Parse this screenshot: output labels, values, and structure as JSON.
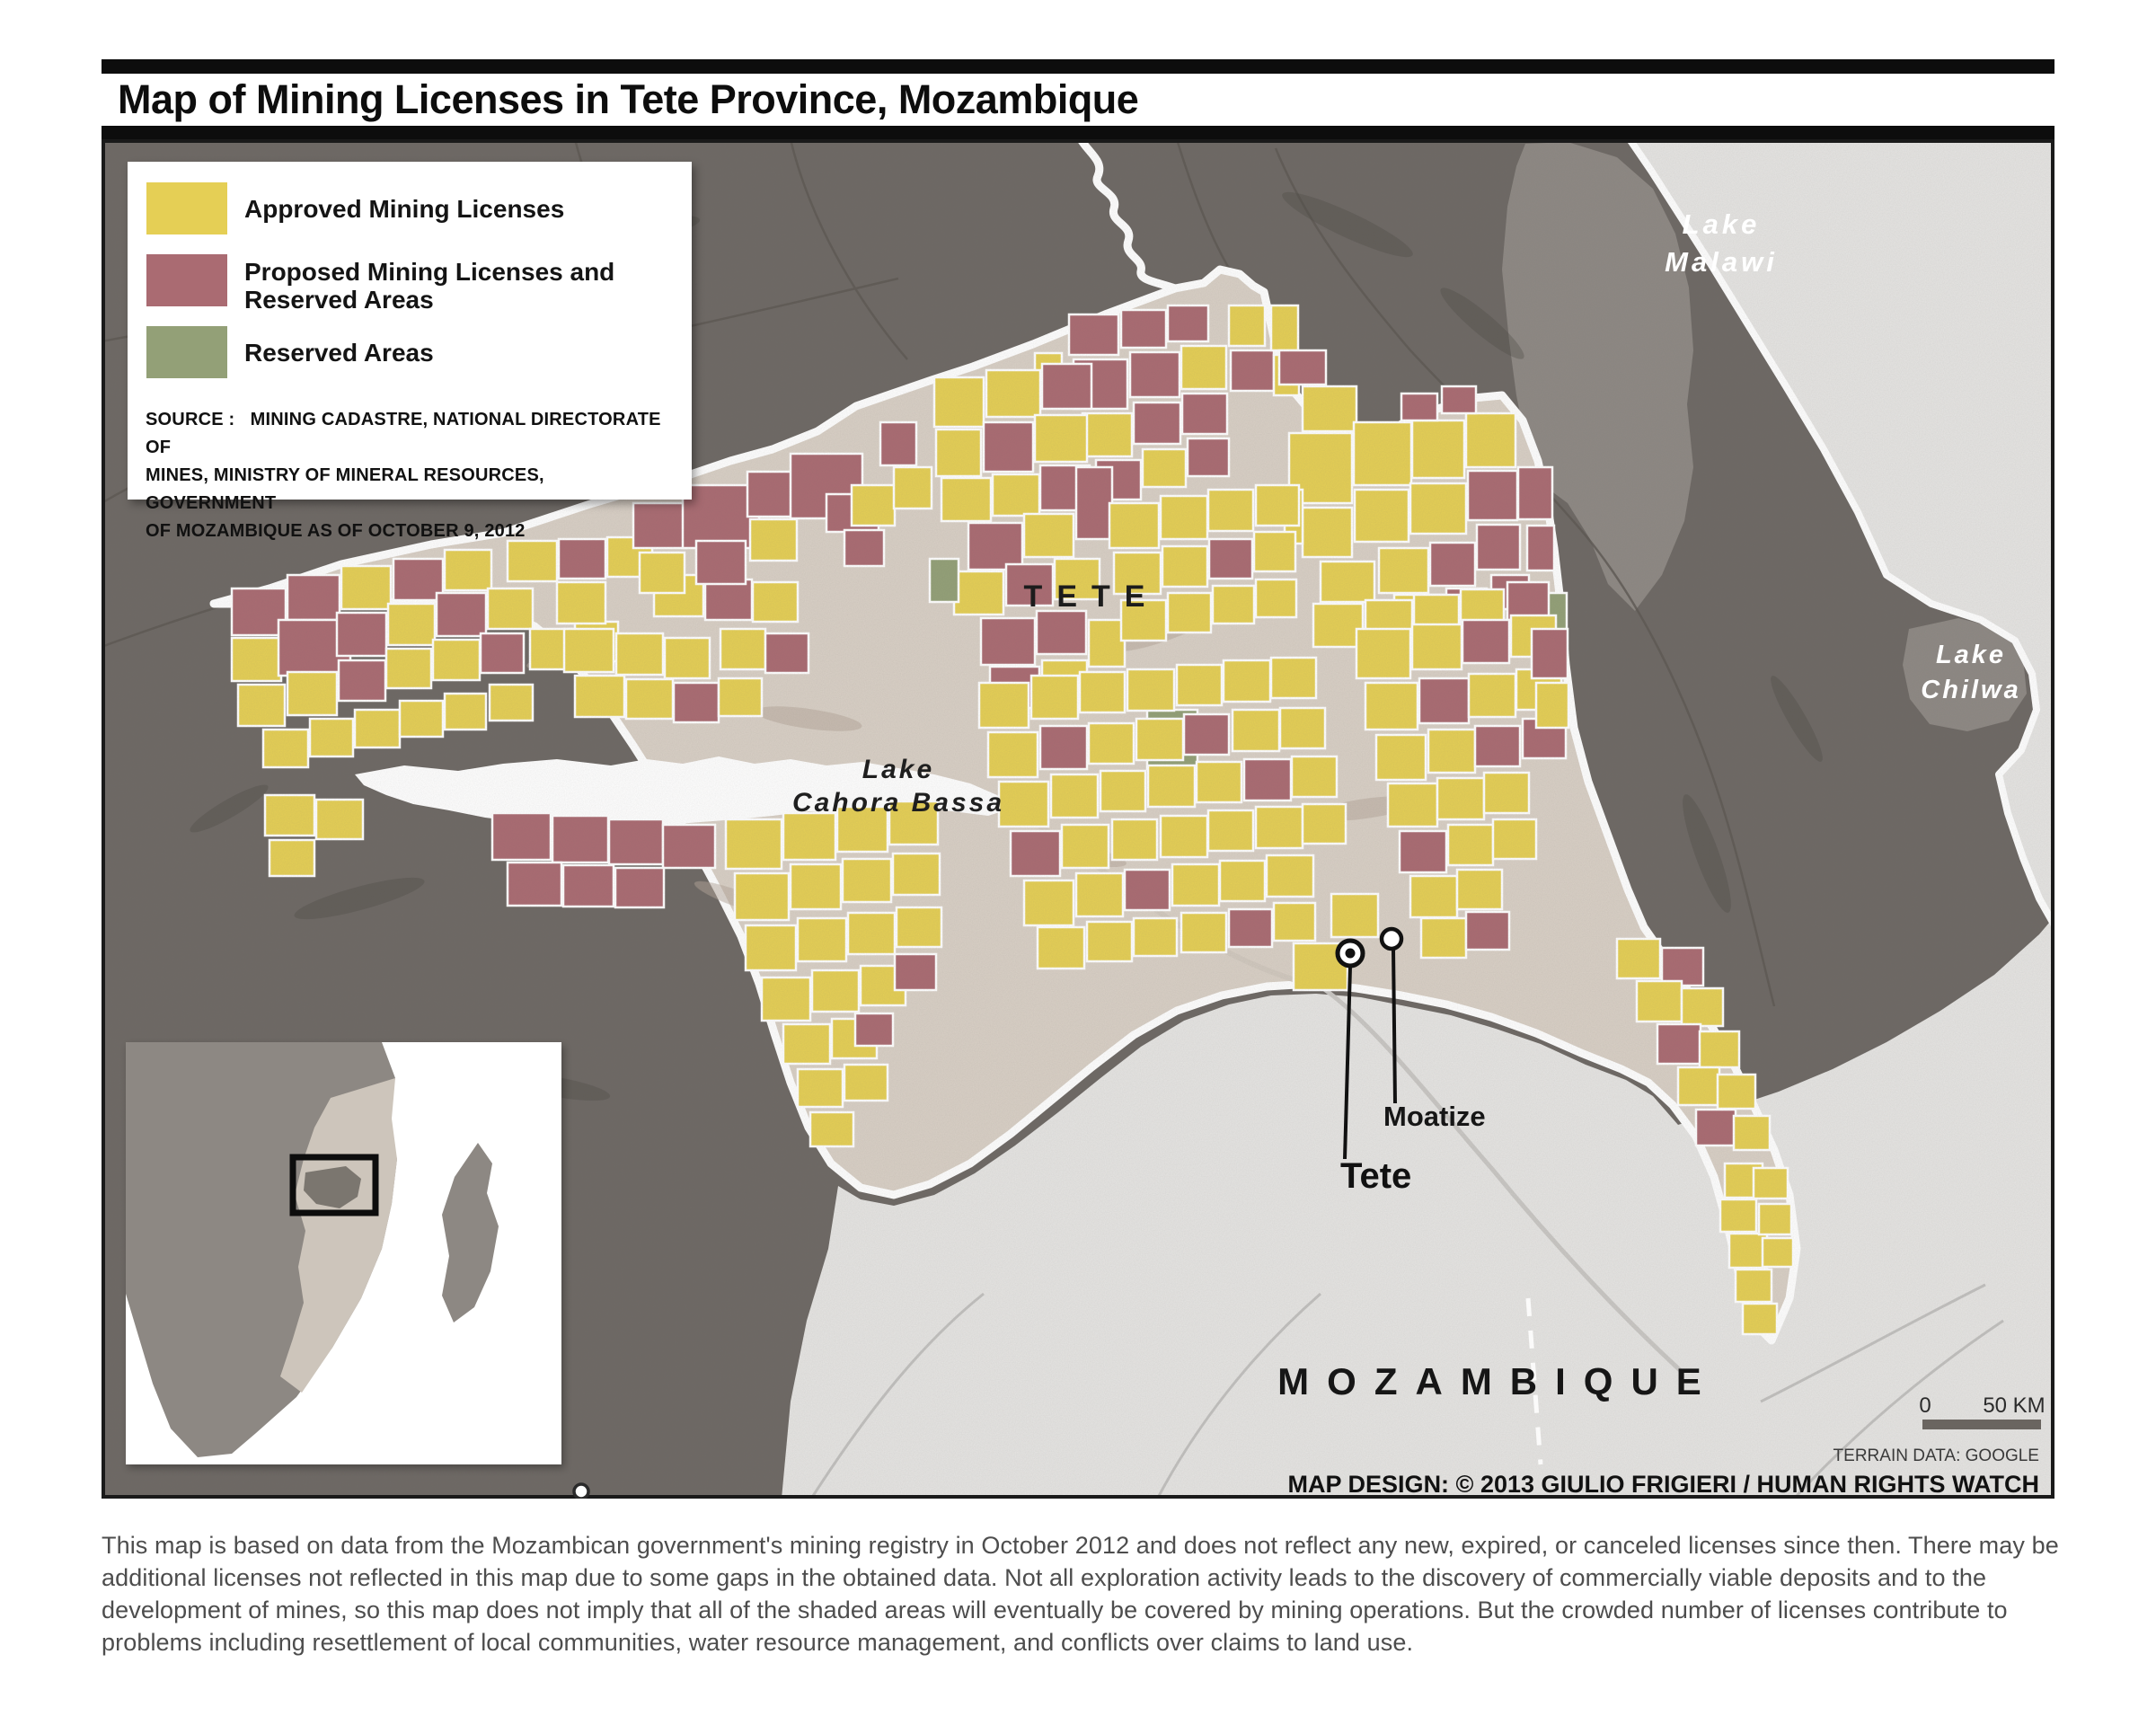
{
  "header": {
    "title": "Map of Mining Licenses in Tete Province, Mozambique"
  },
  "legend": {
    "items": [
      {
        "key": "approved",
        "label": "Approved Mining Licenses",
        "color": "#e5cf55"
      },
      {
        "key": "proposed",
        "label": "Proposed Mining Licenses and Reserved Areas",
        "color": "#aa6b72"
      },
      {
        "key": "reserved",
        "label": "Reserved Areas",
        "color": "#93a077"
      }
    ],
    "source_lines": [
      "SOURCE :   MINING CADASTRE, NATIONAL DIRECTORATE OF",
      "MINES, MINISTRY OF MINERAL RESOURCES, GOVERNMENT",
      "OF MOZAMBIQUE AS OF OCTOBER 9, 2012"
    ]
  },
  "map": {
    "labels": {
      "region": "TETE",
      "country": "MOZAMBIQUE",
      "lake_malawi": [
        "Lake",
        "Malawi"
      ],
      "lake_chilwa": [
        "Lake",
        "Chilwa"
      ],
      "lake_cahora": [
        "Lake",
        "Cahora Bassa"
      ]
    },
    "cities": [
      {
        "name": "Tete"
      },
      {
        "name": "Moatize"
      }
    ],
    "scale": {
      "zero": "0",
      "distance": "50 KM"
    },
    "credits": {
      "terrain": "TERRAIN DATA: GOOGLE",
      "design": "MAP DESIGN: © 2013 GIULIO FRIGIERI / HUMAN RIGHTS WATCH"
    }
  },
  "caption": "This map is based on data from the Mozambican government's mining registry in October 2012 and does not reflect any new, expired, or canceled licenses since then. There may be additional licenses not reflected in this map due to some gaps in the obtained data. Not all exploration activity leads to the discovery of commercially viable deposits and to the development of mines, so this map does not imply that all of the shaded areas will eventually be covered by mining operations. But the crowded number of licenses contribute to problems including resettlement of local communities, water resource management, and conflicts over claims to land use.",
  "colors": {
    "approved": "#e5cf55",
    "proposed": "#aa6b72",
    "reserved": "#93a077",
    "province_fill": "#d9d0c6",
    "terrain_dark": "#6e6965",
    "terrain_light": "#e6e5e3",
    "lake_flat": "#8e8984",
    "water": "#ffffff"
  },
  "licenses": [
    [
      258,
      655,
      60,
      52,
      "p"
    ],
    [
      320,
      640,
      58,
      50,
      "p"
    ],
    [
      380,
      630,
      55,
      48,
      "a"
    ],
    [
      438,
      622,
      55,
      46,
      "p"
    ],
    [
      495,
      612,
      52,
      45,
      "a"
    ],
    [
      258,
      710,
      55,
      48,
      "a"
    ],
    [
      310,
      690,
      80,
      62,
      "p"
    ],
    [
      375,
      682,
      55,
      48,
      "p"
    ],
    [
      432,
      672,
      52,
      46,
      "a"
    ],
    [
      486,
      660,
      55,
      48,
      "p"
    ],
    [
      543,
      655,
      50,
      45,
      "a"
    ],
    [
      265,
      762,
      52,
      46,
      "a"
    ],
    [
      320,
      748,
      55,
      48,
      "a"
    ],
    [
      377,
      735,
      52,
      45,
      "p"
    ],
    [
      430,
      722,
      50,
      44,
      "a"
    ],
    [
      482,
      712,
      52,
      45,
      "a"
    ],
    [
      535,
      705,
      48,
      44,
      "p"
    ],
    [
      590,
      700,
      50,
      45,
      "a"
    ],
    [
      640,
      692,
      48,
      44,
      "a"
    ],
    [
      293,
      812,
      50,
      42,
      "a"
    ],
    [
      345,
      800,
      48,
      42,
      "a"
    ],
    [
      395,
      790,
      50,
      42,
      "a"
    ],
    [
      445,
      780,
      48,
      40,
      "a"
    ],
    [
      495,
      772,
      46,
      40,
      "a"
    ],
    [
      545,
      762,
      48,
      40,
      "a"
    ],
    [
      565,
      602,
      55,
      45,
      "a"
    ],
    [
      622,
      600,
      52,
      44,
      "p"
    ],
    [
      676,
      598,
      50,
      44,
      "a"
    ],
    [
      728,
      640,
      55,
      46,
      "a"
    ],
    [
      785,
      645,
      52,
      45,
      "p"
    ],
    [
      838,
      648,
      50,
      44,
      "a"
    ],
    [
      620,
      648,
      54,
      46,
      "a"
    ],
    [
      800,
      612,
      26,
      16,
      "r"
    ],
    [
      705,
      560,
      60,
      50,
      "p"
    ],
    [
      760,
      540,
      85,
      70,
      "p"
    ],
    [
      832,
      525,
      58,
      50,
      "p"
    ],
    [
      880,
      505,
      80,
      72,
      "p"
    ],
    [
      920,
      550,
      58,
      42,
      "p"
    ],
    [
      948,
      540,
      48,
      45,
      "a"
    ],
    [
      835,
      578,
      52,
      46,
      "a"
    ],
    [
      775,
      602,
      55,
      48,
      "p"
    ],
    [
      712,
      615,
      50,
      45,
      "a"
    ],
    [
      980,
      470,
      40,
      48,
      "p"
    ],
    [
      995,
      520,
      42,
      46,
      "a"
    ],
    [
      940,
      590,
      44,
      40,
      "p"
    ],
    [
      548,
      905,
      65,
      52,
      "p"
    ],
    [
      615,
      908,
      62,
      52,
      "p"
    ],
    [
      678,
      912,
      60,
      50,
      "p"
    ],
    [
      738,
      918,
      58,
      48,
      "p"
    ],
    [
      565,
      960,
      60,
      48,
      "p"
    ],
    [
      627,
      963,
      56,
      46,
      "p"
    ],
    [
      685,
      966,
      54,
      44,
      "p"
    ],
    [
      295,
      885,
      55,
      45,
      "a"
    ],
    [
      352,
      890,
      52,
      44,
      "a"
    ],
    [
      300,
      935,
      50,
      40,
      "a"
    ],
    [
      628,
      700,
      55,
      48,
      "a"
    ],
    [
      686,
      705,
      52,
      46,
      "a"
    ],
    [
      740,
      710,
      50,
      45,
      "a"
    ],
    [
      640,
      752,
      55,
      46,
      "a"
    ],
    [
      697,
      756,
      52,
      44,
      "a"
    ],
    [
      750,
      760,
      50,
      44,
      "p"
    ],
    [
      802,
      700,
      50,
      45,
      "a"
    ],
    [
      852,
      705,
      48,
      44,
      "p"
    ],
    [
      800,
      755,
      48,
      42,
      "a"
    ],
    [
      1152,
      393,
      30,
      40,
      "a"
    ],
    [
      1190,
      350,
      55,
      45,
      "p"
    ],
    [
      1248,
      345,
      50,
      42,
      "p"
    ],
    [
      1300,
      340,
      45,
      40,
      "p"
    ],
    [
      1195,
      400,
      60,
      55,
      "p"
    ],
    [
      1258,
      392,
      55,
      50,
      "p"
    ],
    [
      1315,
      385,
      50,
      48,
      "a"
    ],
    [
      1368,
      340,
      40,
      45,
      "a"
    ],
    [
      1370,
      390,
      48,
      45,
      "p"
    ],
    [
      1205,
      460,
      55,
      48,
      "a"
    ],
    [
      1262,
      448,
      52,
      46,
      "p"
    ],
    [
      1316,
      438,
      50,
      45,
      "p"
    ],
    [
      1220,
      512,
      50,
      44,
      "p"
    ],
    [
      1272,
      500,
      48,
      42,
      "a"
    ],
    [
      1322,
      488,
      46,
      42,
      "p"
    ],
    [
      1415,
      340,
      30,
      50,
      "a"
    ],
    [
      1418,
      395,
      28,
      45,
      "a"
    ],
    [
      1040,
      420,
      55,
      55,
      "a"
    ],
    [
      1098,
      412,
      60,
      52,
      "a"
    ],
    [
      1160,
      405,
      55,
      50,
      "p"
    ],
    [
      1042,
      478,
      50,
      52,
      "a"
    ],
    [
      1095,
      470,
      55,
      55,
      "p"
    ],
    [
      1152,
      462,
      58,
      52,
      "a"
    ],
    [
      1048,
      532,
      55,
      48,
      "a"
    ],
    [
      1105,
      528,
      52,
      46,
      "a"
    ],
    [
      1158,
      518,
      55,
      50,
      "p"
    ],
    [
      1078,
      582,
      60,
      52,
      "p"
    ],
    [
      1140,
      572,
      55,
      48,
      "a"
    ],
    [
      1198,
      520,
      40,
      80,
      "p"
    ],
    [
      1062,
      636,
      55,
      48,
      "a"
    ],
    [
      1120,
      628,
      52,
      46,
      "p"
    ],
    [
      1174,
      622,
      50,
      45,
      "a"
    ],
    [
      1092,
      688,
      60,
      52,
      "p"
    ],
    [
      1154,
      680,
      55,
      48,
      "p"
    ],
    [
      1102,
      742,
      55,
      46,
      "p"
    ],
    [
      1160,
      735,
      50,
      45,
      "a"
    ],
    [
      1212,
      690,
      40,
      52,
      "a"
    ],
    [
      1035,
      622,
      32,
      48,
      "r"
    ],
    [
      1277,
      790,
      56,
      66,
      "r"
    ],
    [
      1706,
      660,
      38,
      46,
      "r"
    ],
    [
      1450,
      430,
      60,
      50,
      "a"
    ],
    [
      1435,
      482,
      70,
      78,
      "a"
    ],
    [
      1507,
      470,
      64,
      70,
      "a"
    ],
    [
      1572,
      468,
      58,
      64,
      "a"
    ],
    [
      1632,
      460,
      55,
      60,
      "a"
    ],
    [
      1560,
      438,
      40,
      30,
      "p"
    ],
    [
      1605,
      430,
      38,
      30,
      "p"
    ],
    [
      1508,
      545,
      60,
      58,
      "a"
    ],
    [
      1570,
      538,
      62,
      56,
      "a"
    ],
    [
      1634,
      524,
      55,
      55,
      "p"
    ],
    [
      1690,
      520,
      38,
      58,
      "p"
    ],
    [
      1450,
      565,
      55,
      55,
      "a"
    ],
    [
      1470,
      625,
      60,
      45,
      "a"
    ],
    [
      1535,
      610,
      55,
      50,
      "a"
    ],
    [
      1592,
      604,
      50,
      48,
      "p"
    ],
    [
      1644,
      584,
      48,
      50,
      "p"
    ],
    [
      1552,
      662,
      55,
      30,
      "a"
    ],
    [
      1610,
      655,
      45,
      34,
      "p"
    ],
    [
      1660,
      640,
      42,
      38,
      "p"
    ],
    [
      1700,
      585,
      30,
      50,
      "p"
    ],
    [
      1424,
      390,
      52,
      38,
      "p"
    ],
    [
      1430,
      545,
      20,
      60,
      "a"
    ],
    [
      1235,
      560,
      55,
      50,
      "a"
    ],
    [
      1292,
      552,
      52,
      48,
      "a"
    ],
    [
      1345,
      545,
      50,
      46,
      "a"
    ],
    [
      1398,
      540,
      48,
      45,
      "a"
    ],
    [
      1240,
      615,
      52,
      46,
      "a"
    ],
    [
      1294,
      608,
      50,
      45,
      "a"
    ],
    [
      1346,
      600,
      48,
      44,
      "p"
    ],
    [
      1396,
      592,
      46,
      44,
      "a"
    ],
    [
      1248,
      668,
      50,
      45,
      "a"
    ],
    [
      1300,
      660,
      48,
      44,
      "a"
    ],
    [
      1350,
      652,
      46,
      42,
      "a"
    ],
    [
      1398,
      645,
      45,
      42,
      "a"
    ],
    [
      1462,
      672,
      55,
      48,
      "a"
    ],
    [
      1520,
      668,
      52,
      46,
      "a"
    ],
    [
      1574,
      662,
      50,
      45,
      "a"
    ],
    [
      1626,
      656,
      48,
      44,
      "a"
    ],
    [
      1678,
      648,
      46,
      42,
      "p"
    ],
    [
      1090,
      760,
      55,
      50,
      "a"
    ],
    [
      1148,
      752,
      52,
      48,
      "a"
    ],
    [
      1202,
      748,
      50,
      45,
      "a"
    ],
    [
      1255,
      745,
      52,
      46,
      "a"
    ],
    [
      1310,
      740,
      50,
      45,
      "a"
    ],
    [
      1362,
      735,
      52,
      46,
      "a"
    ],
    [
      1415,
      732,
      50,
      45,
      "a"
    ],
    [
      1100,
      815,
      55,
      50,
      "a"
    ],
    [
      1158,
      808,
      52,
      48,
      "p"
    ],
    [
      1212,
      805,
      50,
      45,
      "a"
    ],
    [
      1265,
      800,
      52,
      46,
      "a"
    ],
    [
      1318,
      795,
      50,
      45,
      "p"
    ],
    [
      1372,
      790,
      52,
      46,
      "a"
    ],
    [
      1425,
      788,
      50,
      45,
      "a"
    ],
    [
      1112,
      870,
      55,
      50,
      "a"
    ],
    [
      1170,
      862,
      52,
      48,
      "a"
    ],
    [
      1225,
      858,
      50,
      45,
      "a"
    ],
    [
      1278,
      852,
      52,
      46,
      "a"
    ],
    [
      1332,
      848,
      50,
      45,
      "a"
    ],
    [
      1385,
      845,
      52,
      46,
      "p"
    ],
    [
      1438,
      842,
      50,
      45,
      "a"
    ],
    [
      1125,
      925,
      55,
      50,
      "p"
    ],
    [
      1182,
      918,
      52,
      48,
      "a"
    ],
    [
      1238,
      912,
      50,
      45,
      "a"
    ],
    [
      1292,
      908,
      52,
      46,
      "a"
    ],
    [
      1345,
      902,
      50,
      45,
      "a"
    ],
    [
      1398,
      898,
      52,
      46,
      "a"
    ],
    [
      1450,
      895,
      48,
      44,
      "a"
    ],
    [
      1140,
      980,
      55,
      50,
      "a"
    ],
    [
      1198,
      972,
      52,
      48,
      "a"
    ],
    [
      1252,
      968,
      50,
      45,
      "p"
    ],
    [
      1305,
      962,
      52,
      46,
      "a"
    ],
    [
      1358,
      958,
      50,
      45,
      "a"
    ],
    [
      1410,
      952,
      52,
      46,
      "a"
    ],
    [
      1155,
      1032,
      52,
      46,
      "a"
    ],
    [
      1210,
      1026,
      50,
      44,
      "a"
    ],
    [
      1262,
      1022,
      48,
      42,
      "a"
    ],
    [
      1315,
      1016,
      50,
      44,
      "a"
    ],
    [
      1368,
      1012,
      48,
      42,
      "p"
    ],
    [
      1418,
      1005,
      46,
      42,
      "a"
    ],
    [
      1440,
      1050,
      60,
      52,
      "a"
    ],
    [
      1482,
      995,
      52,
      48,
      "a"
    ],
    [
      1510,
      700,
      60,
      55,
      "a"
    ],
    [
      1572,
      695,
      55,
      50,
      "a"
    ],
    [
      1628,
      690,
      52,
      48,
      "p"
    ],
    [
      1682,
      685,
      50,
      46,
      "a"
    ],
    [
      1520,
      760,
      58,
      52,
      "a"
    ],
    [
      1580,
      755,
      55,
      50,
      "p"
    ],
    [
      1635,
      750,
      52,
      48,
      "a"
    ],
    [
      1688,
      745,
      50,
      45,
      "a"
    ],
    [
      1532,
      818,
      55,
      50,
      "a"
    ],
    [
      1590,
      812,
      52,
      48,
      "a"
    ],
    [
      1642,
      808,
      50,
      45,
      "p"
    ],
    [
      1695,
      800,
      48,
      44,
      "p"
    ],
    [
      1545,
      872,
      55,
      48,
      "a"
    ],
    [
      1600,
      866,
      52,
      46,
      "a"
    ],
    [
      1652,
      860,
      50,
      45,
      "a"
    ],
    [
      1558,
      925,
      52,
      46,
      "p"
    ],
    [
      1612,
      918,
      50,
      45,
      "a"
    ],
    [
      1662,
      912,
      48,
      44,
      "a"
    ],
    [
      1570,
      975,
      52,
      46,
      "a"
    ],
    [
      1622,
      968,
      50,
      44,
      "a"
    ],
    [
      1582,
      1022,
      50,
      44,
      "a"
    ],
    [
      1632,
      1015,
      48,
      42,
      "p"
    ],
    [
      1705,
      700,
      40,
      55,
      "p"
    ],
    [
      1710,
      760,
      36,
      50,
      "a"
    ],
    [
      808,
      912,
      62,
      55,
      "a"
    ],
    [
      872,
      905,
      58,
      52,
      "a"
    ],
    [
      932,
      898,
      56,
      50,
      "a"
    ],
    [
      990,
      892,
      54,
      48,
      "a"
    ],
    [
      818,
      972,
      60,
      52,
      "a"
    ],
    [
      880,
      962,
      56,
      50,
      "a"
    ],
    [
      938,
      956,
      54,
      48,
      "a"
    ],
    [
      994,
      950,
      52,
      46,
      "a"
    ],
    [
      830,
      1030,
      56,
      50,
      "a"
    ],
    [
      888,
      1022,
      54,
      48,
      "a"
    ],
    [
      944,
      1016,
      52,
      46,
      "a"
    ],
    [
      998,
      1010,
      50,
      44,
      "a"
    ],
    [
      848,
      1088,
      54,
      48,
      "a"
    ],
    [
      904,
      1080,
      52,
      46,
      "a"
    ],
    [
      958,
      1075,
      50,
      44,
      "a"
    ],
    [
      872,
      1140,
      52,
      44,
      "a"
    ],
    [
      926,
      1134,
      50,
      44,
      "a"
    ],
    [
      888,
      1190,
      50,
      42,
      "a"
    ],
    [
      940,
      1185,
      48,
      40,
      "a"
    ],
    [
      902,
      1238,
      48,
      38,
      "a"
    ],
    [
      996,
      1062,
      46,
      40,
      "p"
    ],
    [
      952,
      1128,
      42,
      36,
      "p"
    ],
    [
      1800,
      1045,
      48,
      44,
      "a"
    ],
    [
      1850,
      1055,
      46,
      42,
      "p"
    ],
    [
      1822,
      1092,
      50,
      45,
      "a"
    ],
    [
      1872,
      1100,
      46,
      42,
      "a"
    ],
    [
      1845,
      1140,
      48,
      44,
      "p"
    ],
    [
      1892,
      1148,
      44,
      40,
      "a"
    ],
    [
      1868,
      1188,
      46,
      42,
      "a"
    ],
    [
      1912,
      1196,
      42,
      38,
      "a"
    ],
    [
      1888,
      1235,
      44,
      40,
      "p"
    ],
    [
      1930,
      1242,
      40,
      38,
      "a"
    ],
    [
      1920,
      1295,
      42,
      38,
      "a"
    ],
    [
      1915,
      1335,
      40,
      36,
      "a"
    ],
    [
      1952,
      1300,
      38,
      34,
      "a"
    ],
    [
      1925,
      1373,
      42,
      38,
      "a"
    ],
    [
      1958,
      1340,
      36,
      34,
      "a"
    ],
    [
      1932,
      1413,
      40,
      36,
      "a"
    ],
    [
      1962,
      1378,
      34,
      32,
      "a"
    ],
    [
      1940,
      1451,
      38,
      34,
      "a"
    ]
  ]
}
